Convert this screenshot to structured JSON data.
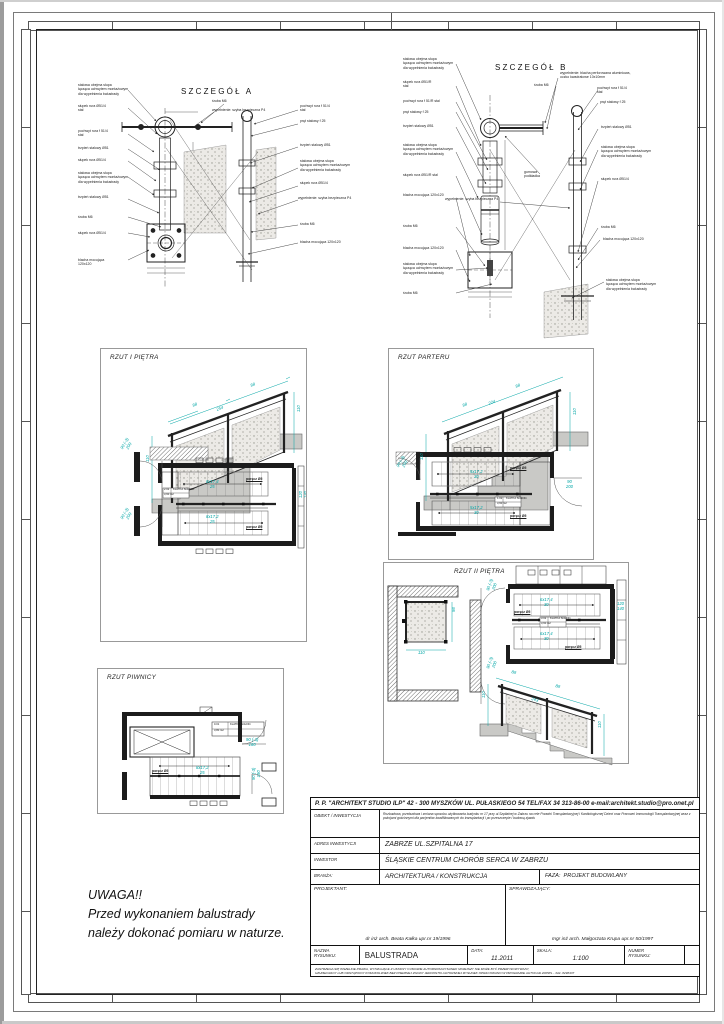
{
  "meta": {
    "accent_cyan": "#00a6a6",
    "line_color": "#1b1b1b",
    "paper": "#ffffff"
  },
  "details": {
    "a_title": "SZCZEGÓŁ A",
    "b_title": "SZCZEGÓŁ B"
  },
  "panels": {
    "floor1_title": "RZUT I PIĘTRA",
    "ground_title": "RZUT PARTERU",
    "floor2_title": "RZUT II PIĘTRA",
    "basement_title": "RZUT PIWNICY"
  },
  "note": {
    "line1": "UWAGA!!",
    "line2": "Przed wykonaniem balustrady",
    "line3": "należy dokonać pomiaru w naturze."
  },
  "titleblock": {
    "company": "P. P. \"ARCHITEKT STUDIO ILP\" 42 - 300 MYSZKÓW UL. PUŁASKIEGO 54 TEL/FAX 34 313-86-00 e-mail:architekt.studio@pro.onet.pl",
    "obiekt_label": "OBIEKT / INWESTYCJA",
    "obiekt_value": "Rozbudowa, przebudowa i zmiana sposobu użytkowania budynku nr 17 przy ul.Szpitalnej w Zabrzu na cele Poradni Transplantacyjnej i Kardiologicznej Dzieci oraz Pracowni Immunologii Transplantacyjnej wraz z pokojami gościnnymi dla pacjentów kwalifikowanych do transplantacji i po przeszczepie i budową zjazdu",
    "adres_label": "ADRES INWESTYCJI",
    "adres_value": "ZABRZE UL.SZPITALNA 17",
    "inwestor_label": "INWESTOR",
    "inwestor_value": "ŚLĄSKIE CENTRUM CHORÓB SERCA W ZABRZU",
    "branza_label": "BRANŻA:",
    "branza_value": "ARCHITEKTURA / KONSTRUKCJA",
    "faza_label": "FAZA:",
    "faza_value": "PROJEKT BUDOWLANY",
    "projektant_label": "PROJEKTANT:",
    "projektant_name": "dr inż arch. Beata Kałka upr.nr 19/1996",
    "sprawdzajacy_label": "SPRAWDZAJĄCY:",
    "sprawdzajacy_name": "mgr inż arch. Małgorzata Krupa upr.nr 50/1997",
    "nazwa_label": "NAZWA\nRYSUNKU:",
    "nazwa_value": "BALUSTRADA",
    "data_label": "DATA:",
    "data_value": "11.2011",
    "skala_label": "SKALA:",
    "skala_value": "1:100",
    "numer_label": "NUMER\nRYSUNKU:",
    "disclaimer1": "ZASTRZEGA SIĘ WSZELKIE PRAWA, WYNIKAJĄCE Z USTAWY O PRAWIE AUTORSKIM.RYSUNEK NINIEJSZY NIE MOŻE BYĆ PRZERYSOWYWANY,",
    "disclaimer2": "UZUPEŁNIANY LUB ODSTĄPIONY KOMUKOLWIEK BEZ PISEMNEJ ZGODY JEDNOSTKI AUTORSKIEJ.RYSUNEK OPRACOWANO W PROGRAMIE AUTOCAD 2005PL - 342- 8298437"
  },
  "callouts": [
    {
      "t": "stalowa obejma słupa\nłącząca uchwytem montażowym\ndla wypełnienia balustrady",
      "x": 78,
      "y": 83
    },
    {
      "t": "słupek rura Ø51/4\nstal",
      "x": 78,
      "y": 104
    },
    {
      "t": "pochwyt rura f 51/4\nstal",
      "x": 78,
      "y": 129
    },
    {
      "t": "trzpień stalowy Ø51",
      "x": 78,
      "y": 146
    },
    {
      "t": "słupek rura Ø51/4",
      "x": 78,
      "y": 158
    },
    {
      "t": "stalowa obejma słupa\nłącząca uchwytem montażowym\ndla wypełnienia balustrady",
      "x": 78,
      "y": 171
    },
    {
      "t": "trzpień stalowy Ø51",
      "x": 78,
      "y": 195
    },
    {
      "t": "śruba M6",
      "x": 78,
      "y": 215
    },
    {
      "t": "słupek rura Ø51/4",
      "x": 78,
      "y": 231
    },
    {
      "t": "blacha mocująca 120x120",
      "x": 78,
      "y": 258,
      "w": 40
    },
    {
      "t": "śruba M6",
      "x": 212,
      "y": 99
    },
    {
      "t": "wypełnienie: szyba bezpieczna P4",
      "x": 212,
      "y": 108
    },
    {
      "t": "pochwyt rura f 51/4\nstal",
      "x": 300,
      "y": 104
    },
    {
      "t": "pręt stalowy  f 25",
      "x": 300,
      "y": 119
    },
    {
      "t": "trzpień stalowy Ø51",
      "x": 300,
      "y": 143
    },
    {
      "t": "stalowa obejma słupa\nłącząca uchwytem montażowym\ndla wypełnienia balustrady",
      "x": 300,
      "y": 159
    },
    {
      "t": "słupek rura Ø51/4",
      "x": 300,
      "y": 181
    },
    {
      "t": "wypełnienie: szyba bezpieczna P4",
      "x": 298,
      "y": 196,
      "w": 55
    },
    {
      "t": "śruba M6",
      "x": 300,
      "y": 222
    },
    {
      "t": "blacha mocująca 120x120",
      "x": 300,
      "y": 240,
      "w": 45
    },
    {
      "t": "stalowa obejma słupa\nłącząca uchwytem montażowym\ndla wypełnienia balustrady",
      "x": 403,
      "y": 57
    },
    {
      "t": "słupek rura Ø51/R\nstal",
      "x": 403,
      "y": 80
    },
    {
      "t": "pochwyt rura f 51/R stal",
      "x": 403,
      "y": 99
    },
    {
      "t": "pręt stalowy  f 25",
      "x": 403,
      "y": 110
    },
    {
      "t": "trzpień stalowy Ø51",
      "x": 403,
      "y": 124
    },
    {
      "t": "stalowa obejma słupa\nłącząca uchwytem montażowym\ndla wypełnienia balustrady",
      "x": 403,
      "y": 143
    },
    {
      "t": "słupek rura Ø51/R stal",
      "x": 403,
      "y": 173
    },
    {
      "t": "blacha mocująca 120x120",
      "x": 403,
      "y": 193,
      "w": 45
    },
    {
      "t": "śruba M6",
      "x": 403,
      "y": 224
    },
    {
      "t": "blacha mocująca 120x120",
      "x": 403,
      "y": 246,
      "w": 45
    },
    {
      "t": "stalowa obejma słupa\nłącząca uchwytem montażowym\ndla wypełnienia balustrady",
      "x": 403,
      "y": 262
    },
    {
      "t": "śruba M6",
      "x": 403,
      "y": 291
    },
    {
      "t": "wypełnienie: blacha perforowana aluminiowa,\noczko kwadratowe 10x10mm",
      "x": 560,
      "y": 71
    },
    {
      "t": "śruba M6",
      "x": 534,
      "y": 83
    },
    {
      "t": "pochwyt rura f 51/4\nstal",
      "x": 597,
      "y": 86
    },
    {
      "t": "pręt stalowy  f 25",
      "x": 600,
      "y": 100
    },
    {
      "t": "gumowa\npodkładka",
      "x": 524,
      "y": 170
    },
    {
      "t": "trzpień stalowy Ø51",
      "x": 601,
      "y": 125
    },
    {
      "t": "stalowa obejma słupa\nłącząca uchwytem montażowym\ndla wypełnienia balustrady",
      "x": 601,
      "y": 145
    },
    {
      "t": "słupek rura Ø51/4",
      "x": 601,
      "y": 177
    },
    {
      "t": "wypełnienie: szyba bezpieczna P4",
      "x": 445,
      "y": 197,
      "w": 60
    },
    {
      "t": "śruba M6",
      "x": 601,
      "y": 225
    },
    {
      "t": "blacha mocująca 120x120",
      "x": 603,
      "y": 237,
      "w": 48
    },
    {
      "t": "stalowa obejma słupa\nłącząca uchwytem montażowym\ndla wypełnienia balustrady",
      "x": 606,
      "y": 278
    },
    {
      "t": "88",
      "x": 192,
      "y": 404,
      "r": -20,
      "c": "dim"
    },
    {
      "t": "88",
      "x": 250,
      "y": 384,
      "r": -20,
      "c": "dim"
    },
    {
      "t": "254",
      "x": 216,
      "y": 408,
      "r": -20,
      "c": "dim"
    },
    {
      "t": "110",
      "x": 146,
      "y": 462,
      "r": -90,
      "c": "dim"
    },
    {
      "t": "110",
      "x": 297,
      "y": 412,
      "r": -90,
      "c": "dim"
    },
    {
      "t": "8x17,4\n25",
      "x": 206,
      "y": 480,
      "c": "dim"
    },
    {
      "t": "8x17,2\n25",
      "x": 206,
      "y": 515,
      "c": "dim"
    },
    {
      "t": "poręcz Ø5",
      "x": 246,
      "y": 477,
      "c": "bold"
    },
    {
      "t": "poręcz Ø5",
      "x": 246,
      "y": 525,
      "c": "bold"
    },
    {
      "t": "90 (-3)\n200",
      "x": 120,
      "y": 448,
      "r": -60,
      "c": "dim"
    },
    {
      "t": "90 (-3)\n200",
      "x": 120,
      "y": 518,
      "r": -60,
      "c": "dim"
    },
    {
      "t": "120\n140",
      "x": 299,
      "y": 498,
      "r": -90,
      "c": "dim"
    },
    {
      "t": "2.02",
      "x": 164,
      "y": 489,
      "c": "room"
    },
    {
      "t": "KLATKA SCHOD.",
      "x": 173,
      "y": 489,
      "c": "room"
    },
    {
      "t": "3,60 m2",
      "x": 164,
      "y": 493.5,
      "c": "room"
    },
    {
      "t": "88",
      "x": 462,
      "y": 404,
      "r": -20,
      "c": "dim"
    },
    {
      "t": "88",
      "x": 515,
      "y": 385,
      "r": -20,
      "c": "dim"
    },
    {
      "t": "224",
      "x": 488,
      "y": 402,
      "r": -20,
      "c": "dim"
    },
    {
      "t": "110",
      "x": 420,
      "y": 460,
      "r": -90,
      "c": "dim"
    },
    {
      "t": "110",
      "x": 573,
      "y": 415,
      "r": -90,
      "c": "dim"
    },
    {
      "t": "5x17,2\n30",
      "x": 470,
      "y": 470,
      "c": "dim"
    },
    {
      "t": "5x17,2\n30",
      "x": 470,
      "y": 506,
      "c": "dim"
    },
    {
      "t": "poręcz Ø5",
      "x": 510,
      "y": 466,
      "c": "bold"
    },
    {
      "t": "poręcz Ø5",
      "x": 510,
      "y": 514,
      "c": "bold"
    },
    {
      "t": "90\n200",
      "x": 566,
      "y": 480,
      "c": "dim"
    },
    {
      "t": "90 (-3)\n200",
      "x": 396,
      "y": 466,
      "r": -60,
      "c": "dim"
    },
    {
      "t": "1.02",
      "x": 497,
      "y": 498,
      "c": "room"
    },
    {
      "t": "KLATKA SCHOD.",
      "x": 506,
      "y": 498,
      "c": "room"
    },
    {
      "t": "3,60 m2",
      "x": 497,
      "y": 502.5,
      "c": "room"
    },
    {
      "t": "98",
      "x": 452,
      "y": 612,
      "r": -90,
      "c": "dim"
    },
    {
      "t": "110",
      "x": 418,
      "y": 651,
      "c": "dim"
    },
    {
      "t": "6x17,4\n30",
      "x": 540,
      "y": 598,
      "c": "dim"
    },
    {
      "t": "6x17,4\n30",
      "x": 540,
      "y": 632,
      "c": "dim"
    },
    {
      "t": "poręcz Ø5",
      "x": 514,
      "y": 610,
      "c": "bold"
    },
    {
      "t": "poręcz Ø5",
      "x": 565,
      "y": 645,
      "c": "bold"
    },
    {
      "t": "120\n140",
      "x": 617,
      "y": 602,
      "c": "dim"
    },
    {
      "t": "90 (-3)\n200",
      "x": 486,
      "y": 590,
      "r": -70,
      "c": "dim"
    },
    {
      "t": "90 (-3)\n200",
      "x": 486,
      "y": 668,
      "r": -70,
      "c": "dim"
    },
    {
      "t": "3.02",
      "x": 541,
      "y": 618,
      "c": "room"
    },
    {
      "t": "KLATKA SCHOD.",
      "x": 550,
      "y": 618,
      "c": "room"
    },
    {
      "t": "3,60 m2",
      "x": 541,
      "y": 622.5,
      "c": "room"
    },
    {
      "t": "88",
      "x": 512,
      "y": 670,
      "r": 17,
      "c": "dim"
    },
    {
      "t": "88",
      "x": 556,
      "y": 684,
      "r": 17,
      "c": "dim"
    },
    {
      "t": "243",
      "x": 532,
      "y": 697,
      "r": 17,
      "c": "dim"
    },
    {
      "t": "110",
      "x": 482,
      "y": 698,
      "r": -90,
      "c": "dim"
    },
    {
      "t": "110",
      "x": 598,
      "y": 728,
      "r": -90,
      "c": "dim"
    },
    {
      "t": "poręcz Ø5",
      "x": 152,
      "y": 769,
      "c": "bold"
    },
    {
      "t": "8x17,2\n25",
      "x": 196,
      "y": 766,
      "c": "dim"
    },
    {
      "t": "90 (-3)\n180",
      "x": 246,
      "y": 738,
      "c": "dim"
    },
    {
      "t": "90 (-3)\n190",
      "x": 252,
      "y": 780,
      "r": -90,
      "c": "dim"
    },
    {
      "t": "0.01",
      "x": 214,
      "y": 724,
      "c": "room"
    },
    {
      "t": "KLATKA SCHOD.",
      "x": 230,
      "y": 724,
      "c": "room"
    },
    {
      "t": "3,80 m2",
      "x": 214,
      "y": 729.5,
      "c": "room"
    }
  ]
}
